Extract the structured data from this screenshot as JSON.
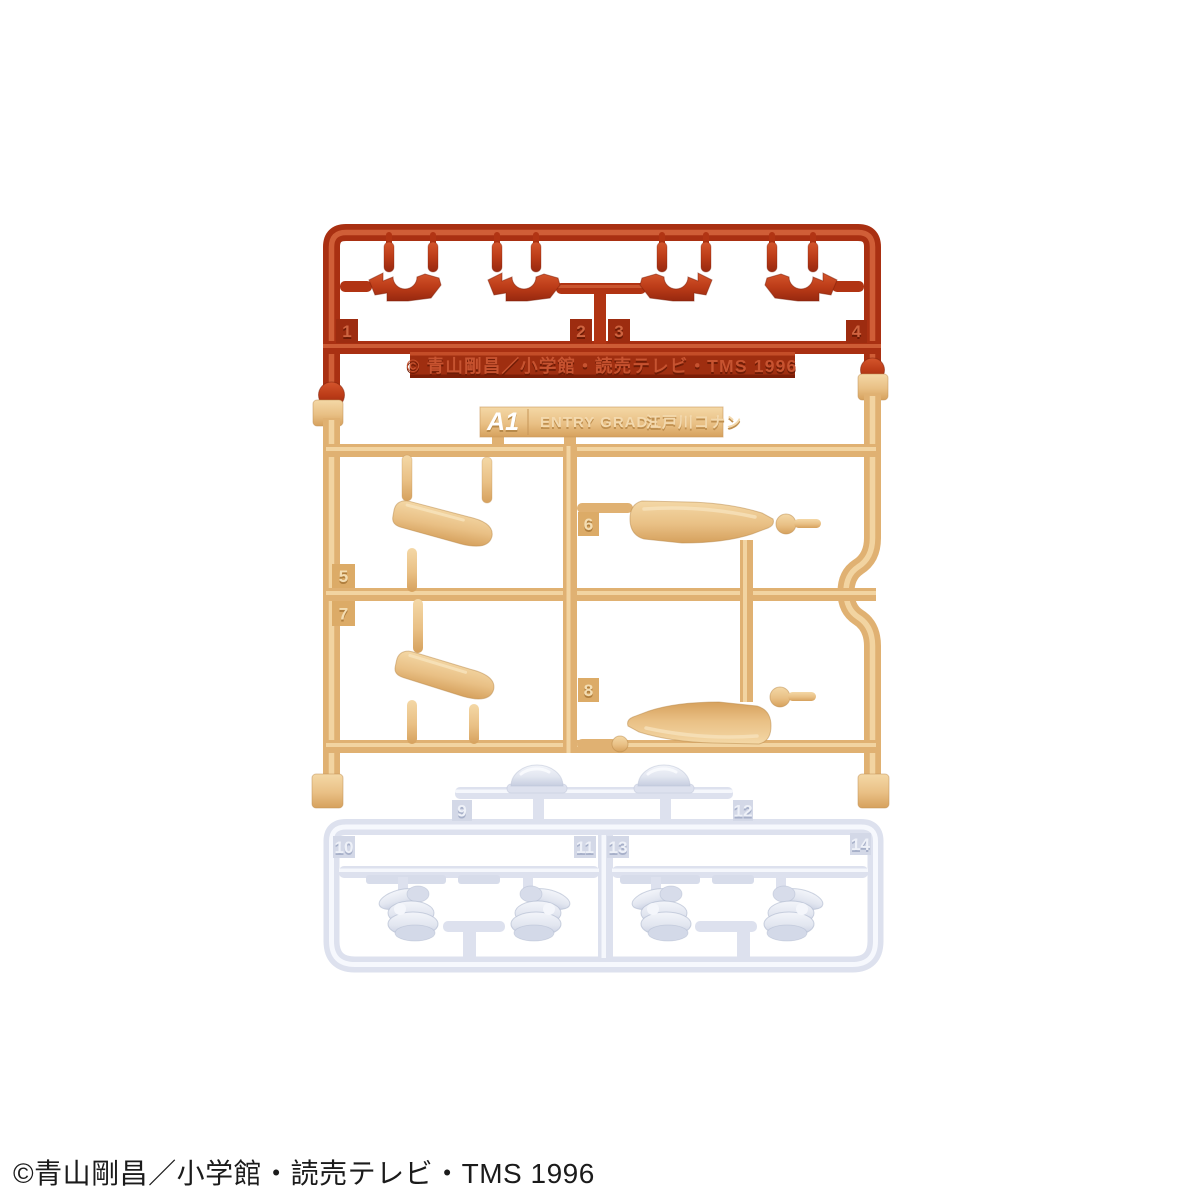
{
  "photo": {
    "footer_copyright": "©青山剛昌／小学館・読売テレビ・TMS 1996"
  },
  "runner": {
    "tag": {
      "code": "A1",
      "grade": "ENTRY GRADE",
      "character": "江戸川コナン"
    },
    "molded_copyright": "© 青山剛昌／小学館・読売テレビ・TMS 1996",
    "part_numbers": {
      "red": [
        "1",
        "2",
        "3",
        "4"
      ],
      "tan": [
        "5",
        "6",
        "7",
        "8"
      ],
      "white": [
        "9",
        "10",
        "11",
        "12",
        "13",
        "14"
      ]
    }
  },
  "colors": {
    "red_plastic": "#b13413",
    "red_dark": "#8c2510",
    "red_light": "#d4643c",
    "tan_plastic": "#e7bb7c",
    "tan_dark": "#c9985a",
    "tan_light": "#f4d8a6",
    "white_plastic": "#e2e6f0",
    "white_dark": "#c2c9dc",
    "white_light": "#f7f9fd",
    "tag_text": "#ffffff",
    "background": "#ffffff",
    "footer_text": "#1b1b1b"
  }
}
